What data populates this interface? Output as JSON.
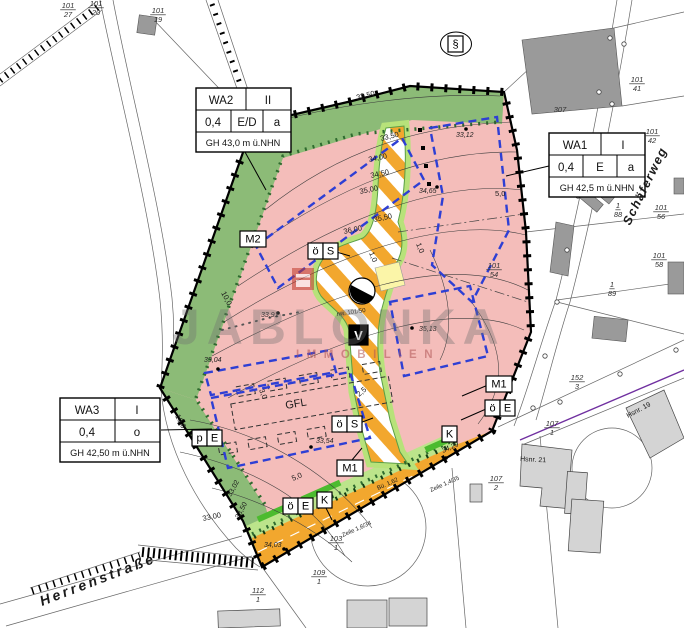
{
  "plan": {
    "watermark": {
      "title": "JABLONKA",
      "subtitle": "IMMOBILIEN"
    },
    "colors": {
      "residential": "#F4BDBA",
      "green_strip": "#8CBB77",
      "verge": "#BCE48B",
      "road": "#F2A72E",
      "envelope": "#2E3FD4",
      "utility_yellow": "#FBF5A8",
      "boundary_purple": "#7030A0",
      "logo_red": "#c0392b"
    },
    "zones": {
      "wa2": {
        "name": "WA2",
        "floors": "II",
        "grz": "0,4",
        "bauweise": "E/D",
        "dach": "a",
        "gh": "GH 43,0 m ü.NHN"
      },
      "wa1": {
        "name": "WA1",
        "floors": "I",
        "grz": "0,4",
        "bauweise": "E",
        "dach": "a",
        "gh": "GH 42,5 m ü.NHN"
      },
      "wa3": {
        "name": "WA3",
        "floors": "I",
        "grz": "0,4",
        "bauweise": "o",
        "gh": "GH 42,50 m ü.NHN"
      }
    },
    "tags": [
      {
        "id": "m2",
        "cells": [
          "M2"
        ],
        "x": 240,
        "y": 231
      },
      {
        "id": "oes-1",
        "cells": [
          "ö",
          "S"
        ],
        "x": 308,
        "y": 243
      },
      {
        "id": "oes-2",
        "cells": [
          "ö",
          "S"
        ],
        "x": 332,
        "y": 416
      },
      {
        "id": "m1-1",
        "cells": [
          "M1"
        ],
        "x": 337,
        "y": 460
      },
      {
        "id": "m1-2",
        "cells": [
          "M1"
        ],
        "x": 486,
        "y": 376
      },
      {
        "id": "oee-1",
        "cells": [
          "ö",
          "E"
        ],
        "x": 283,
        "y": 498
      },
      {
        "id": "oee-2",
        "cells": [
          "ö",
          "E"
        ],
        "x": 485,
        "y": 400
      },
      {
        "id": "k-1",
        "cells": [
          "K"
        ],
        "x": 317,
        "y": 492
      },
      {
        "id": "k-2",
        "cells": [
          "K"
        ],
        "x": 442,
        "y": 426
      },
      {
        "id": "pe",
        "cells": [
          "p",
          "E"
        ],
        "x": 192,
        "y": 430
      },
      {
        "id": "v",
        "cells": [
          "V"
        ],
        "x": 349,
        "y": 325,
        "inv": true
      },
      {
        "id": "paragraph",
        "cells": [
          "§"
        ],
        "x": 448,
        "y": 36,
        "ellipse": true
      }
    ],
    "labels": [
      {
        "t": "Herrenstraße",
        "x": 42,
        "y": 606,
        "s": 14,
        "r": -21,
        "w": 1,
        "i": 1,
        "ls": 3,
        "n": "street-name-herrenstrasse"
      },
      {
        "t": "Schäferweg",
        "x": 630,
        "y": 226,
        "s": 12.5,
        "r": -64,
        "w": 1,
        "i": 1,
        "ls": 1.5,
        "n": "street-name-schaeferweg"
      },
      {
        "t": "32,50",
        "x": 357,
        "y": 100,
        "s": 7.5,
        "r": -14,
        "n": "contour-label"
      },
      {
        "t": "33,50",
        "x": 381,
        "y": 141,
        "s": 7.5,
        "r": -14,
        "n": "contour-label"
      },
      {
        "t": "34,00",
        "x": 369,
        "y": 162,
        "s": 7.5,
        "r": -12,
        "n": "contour-label"
      },
      {
        "t": "34,50",
        "x": 371,
        "y": 178,
        "s": 7.5,
        "r": -12,
        "n": "contour-label"
      },
      {
        "t": "35,00",
        "x": 360,
        "y": 194,
        "s": 7.5,
        "r": -12,
        "n": "contour-label"
      },
      {
        "t": "35,50",
        "x": 374,
        "y": 222,
        "s": 7.5,
        "r": -12,
        "n": "contour-label"
      },
      {
        "t": "36,00",
        "x": 344,
        "y": 234,
        "s": 7.5,
        "r": -12,
        "n": "contour-label"
      },
      {
        "t": "33,00",
        "x": 203,
        "y": 521,
        "s": 7.5,
        "r": -12,
        "n": "contour-label"
      },
      {
        "t": "33,02",
        "x": 231,
        "y": 497,
        "s": 7,
        "r": -62,
        "n": "contour-label"
      },
      {
        "t": "33,50",
        "x": 239,
        "y": 519,
        "s": 7,
        "r": -62,
        "n": "contour-label"
      },
      {
        "t": "1,0",
        "x": 369,
        "y": 253,
        "s": 7.5,
        "r": 68,
        "n": "dimension-label"
      },
      {
        "t": "1,0",
        "x": 416,
        "y": 244,
        "s": 7.5,
        "r": 68,
        "n": "dimension-label"
      },
      {
        "t": "5,0",
        "x": 495,
        "y": 196,
        "s": 7.5,
        "n": "dimension-label"
      },
      {
        "t": "5,0",
        "x": 293,
        "y": 481,
        "s": 7.5,
        "r": -24,
        "n": "dimension-label"
      },
      {
        "t": "2,5",
        "x": 359,
        "y": 397,
        "s": 7.5,
        "r": -40,
        "n": "dimension-label"
      },
      {
        "t": "3,0",
        "x": 259,
        "y": 390,
        "s": 7.5,
        "r": 68,
        "n": "dimension-label"
      },
      {
        "t": "10,0",
        "x": 221,
        "y": 293,
        "s": 7.5,
        "r": 62,
        "n": "dimension-label"
      },
      {
        "t": "10,0",
        "x": 175,
        "y": 416,
        "s": 7.5,
        "r": 62,
        "n": "dimension-label"
      },
      {
        "t": "Zeile 1,6/34",
        "x": 343,
        "y": 537,
        "s": 6,
        "r": -24,
        "n": "annotation"
      },
      {
        "t": "Zeile 1,4/35",
        "x": 431,
        "y": 492,
        "s": 6,
        "r": -24,
        "n": "annotation"
      },
      {
        "t": "Bü. 1,62",
        "x": 378,
        "y": 490,
        "s": 6,
        "r": -24,
        "n": "annotation"
      },
      {
        "t": "nw. 101/50",
        "x": 337,
        "y": 316,
        "s": 6,
        "r": -8,
        "n": "annotation"
      },
      {
        "t": "GFL",
        "x": 286,
        "y": 409,
        "s": 11,
        "r": -10,
        "n": "gfl-label"
      },
      {
        "t": "Hsnr. 19",
        "x": 628,
        "y": 418,
        "s": 7,
        "r": -28,
        "n": "building-label"
      },
      {
        "t": "Hsnr. 21",
        "x": 520,
        "y": 461,
        "s": 7,
        "r": 3,
        "n": "building-label"
      }
    ],
    "spot_heights": [
      {
        "t": "33,12",
        "x": 456,
        "y": 137,
        "cx": 466,
        "cy": 129
      },
      {
        "t": "34,65",
        "x": 419,
        "y": 193,
        "cx": 437,
        "cy": 187
      },
      {
        "t": "35,13",
        "x": 419,
        "y": 331,
        "cx": 412,
        "cy": 328
      },
      {
        "t": "33,91",
        "x": 261,
        "y": 317,
        "cx": 278,
        "cy": 313
      },
      {
        "t": "33,04",
        "x": 204,
        "y": 362,
        "cx": 218,
        "cy": 369
      },
      {
        "t": "33,54",
        "x": 316,
        "y": 443,
        "cx": 311,
        "cy": 447
      },
      {
        "t": "34,03",
        "x": 264,
        "y": 547,
        "cx": 284,
        "cy": 549
      },
      {
        "t": "34,29",
        "x": 443,
        "y": 453,
        "r": -24,
        "cx": 446,
        "cy": 458
      }
    ],
    "parcels": [
      {
        "num": "101",
        "den": "27",
        "x": 68,
        "y": 8
      },
      {
        "num": "101",
        "den": "20",
        "x": 96,
        "y": 6
      },
      {
        "num": "101",
        "den": "19",
        "x": 158,
        "y": 13
      },
      {
        "num": "101",
        "den": "41",
        "x": 637,
        "y": 82
      },
      {
        "num": "101",
        "den": "42",
        "x": 652,
        "y": 134
      },
      {
        "num": "307",
        "x": 560,
        "y": 112
      },
      {
        "num": "1",
        "den": "88",
        "x": 618,
        "y": 208
      },
      {
        "num": "101",
        "den": "56",
        "x": 661,
        "y": 210
      },
      {
        "num": "101",
        "den": "58",
        "x": 659,
        "y": 258
      },
      {
        "num": "1",
        "den": "89",
        "x": 612,
        "y": 287
      },
      {
        "num": "101",
        "den": "54",
        "x": 494,
        "y": 268
      },
      {
        "num": "152",
        "den": "3",
        "x": 577,
        "y": 380
      },
      {
        "num": "107",
        "den": "1",
        "x": 552,
        "y": 426
      },
      {
        "num": "107",
        "den": "2",
        "x": 496,
        "y": 481
      },
      {
        "num": "103",
        "den": "1",
        "x": 336,
        "y": 541
      },
      {
        "num": "109",
        "den": "1",
        "x": 319,
        "y": 575
      },
      {
        "num": "112",
        "den": "1",
        "x": 258,
        "y": 593
      }
    ]
  }
}
